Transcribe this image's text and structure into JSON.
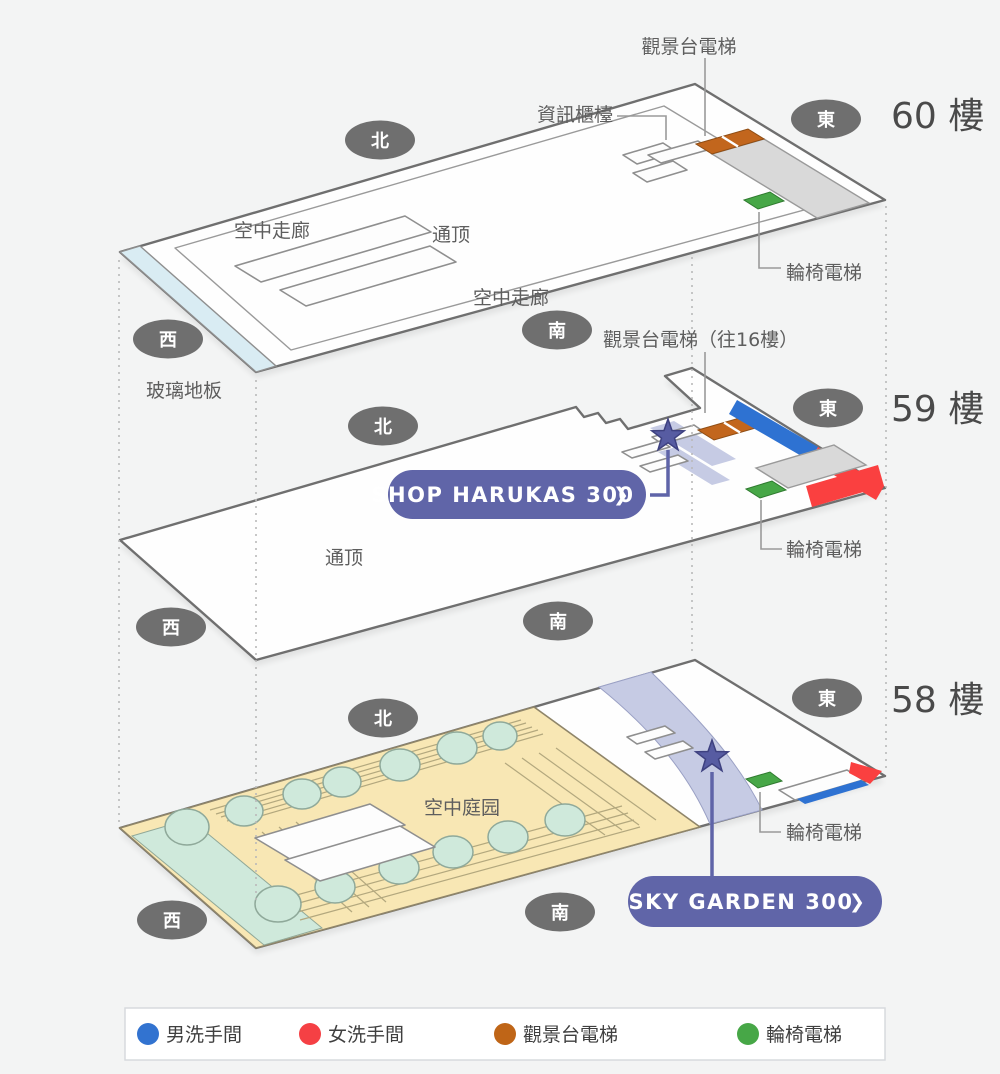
{
  "colors": {
    "background": "#f3f4f4",
    "accent_purple": "#6065a8",
    "star_purple": "#575ca2",
    "men_blue": "#2e72d2",
    "women_red": "#fa4040",
    "obs_orange": "#c2661d",
    "wheel_green": "#47a747",
    "glass_blue": "#d9ecf3",
    "garden_tan": "#f8e7b4",
    "walkway_lavender": "#c6cbe4"
  },
  "floors": {
    "f60": {
      "title": "60 樓",
      "dir_north": "北",
      "dir_east": "東",
      "dir_west": "西",
      "dir_south": "南",
      "obs_elevator": "觀景台電梯",
      "info_counter": "資訊櫃檯",
      "sky_corridor_a": "空中走廊",
      "sky_corridor_b": "空中走廊",
      "atrium": "通顶",
      "glass_floor": "玻璃地板",
      "wheelchair_elevator": "輪椅電梯",
      "obs_elevator_to16": "觀景台電梯（往16樓）"
    },
    "f59": {
      "title": "59 樓",
      "dir_north": "北",
      "dir_east": "東",
      "dir_west": "西",
      "dir_south": "南",
      "atrium": "通顶",
      "wheelchair_elevator": "輪椅電梯",
      "shop_button": {
        "label": "SHOP HARUKAS 300",
        "chevron": "❯"
      }
    },
    "f58": {
      "title": "58 樓",
      "dir_north": "北",
      "dir_east": "東",
      "dir_west": "西",
      "dir_south": "南",
      "garden": "空中庭园",
      "wheelchair_elevator": "輪椅電梯",
      "garden_button": {
        "label": "SKY GARDEN 300",
        "chevron": "❯"
      }
    }
  },
  "legend": {
    "items": [
      {
        "label": "男洗手間",
        "color": "#3273d0"
      },
      {
        "label": "女洗手間",
        "color": "#f54044"
      },
      {
        "label": "觀景台電梯",
        "color": "#bf6517"
      },
      {
        "label": "輪椅電梯",
        "color": "#47a747"
      }
    ]
  }
}
